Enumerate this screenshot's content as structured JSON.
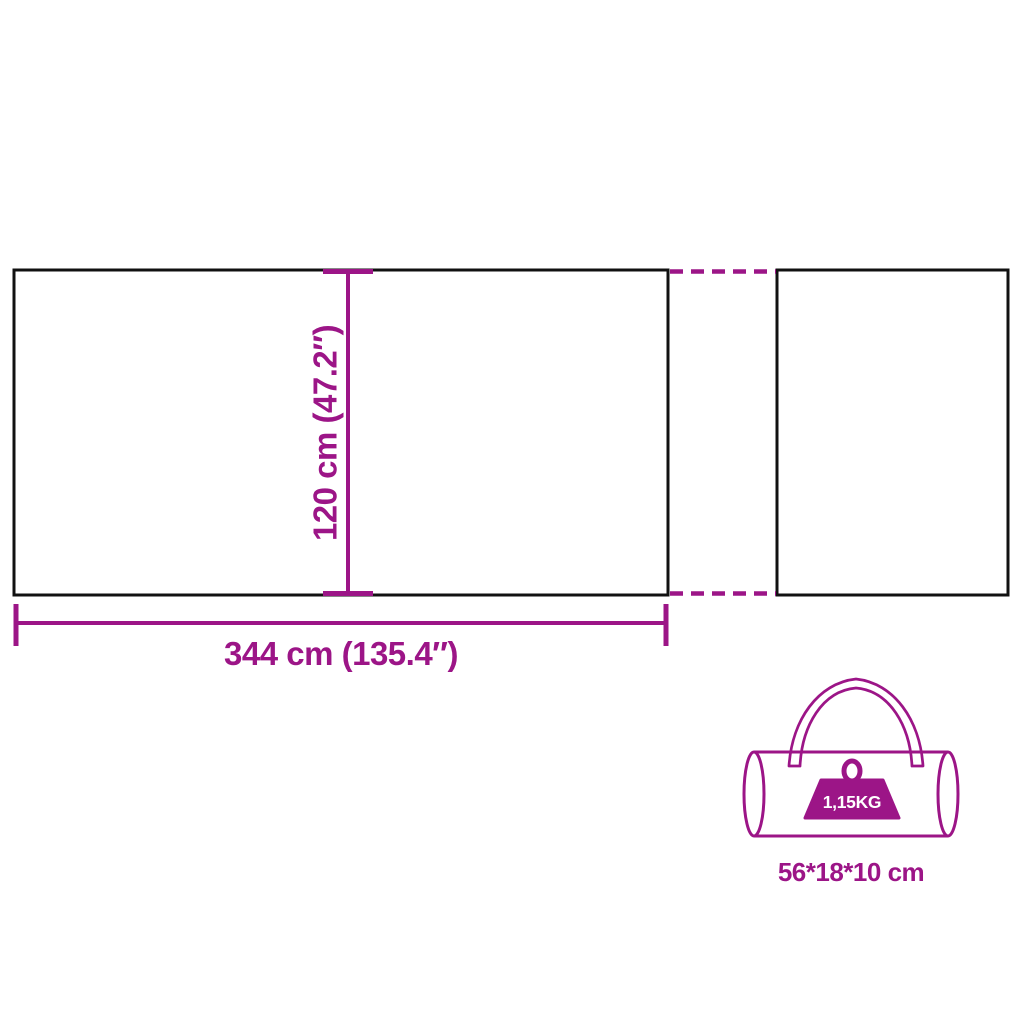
{
  "diagram": {
    "accent_color": "#9C1587",
    "outline_color": "#111111",
    "background_color": "#ffffff",
    "height_dimension": {
      "label": "120 cm (47.2″)"
    },
    "width_dimension": {
      "label": "344 cm (135.4″)"
    },
    "bag": {
      "weight_badge": "1,15KG",
      "size_label": "56*18*10 cm"
    }
  }
}
